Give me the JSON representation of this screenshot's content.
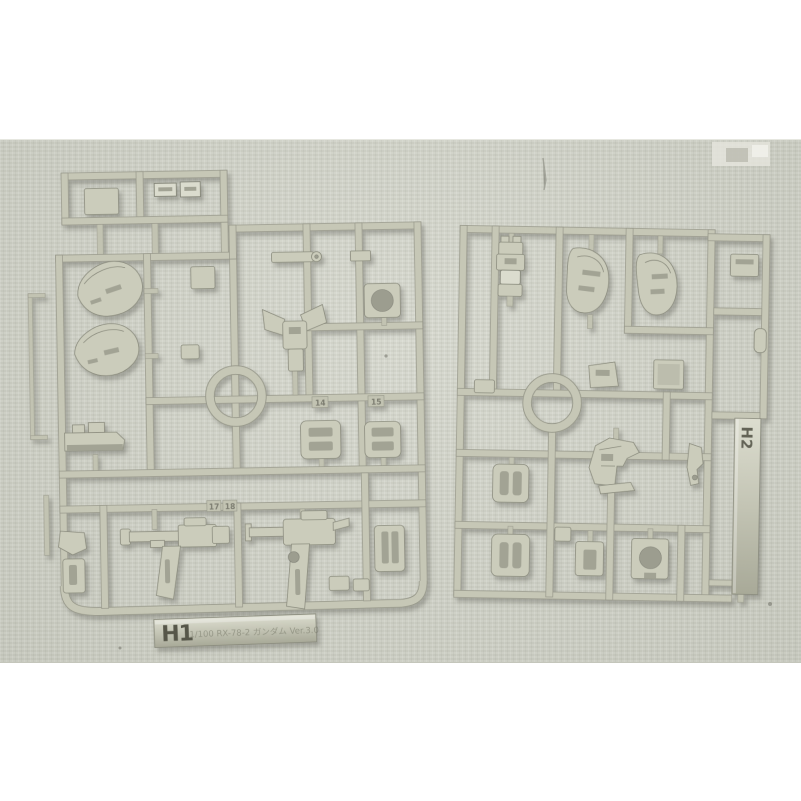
{
  "photo": {
    "subject": "Two beige plastic model-kit part runners (sprues) photographed on gray fabric",
    "fabric_hex": "#d2d4c9",
    "plastic_hex": "#c6c7b6",
    "border_hex": "#ffffff"
  },
  "left_runner": {
    "tag_label": "H1",
    "tag_inscription": "1/100 RX-78-2 ガンダム Ver.3.0",
    "molded_numbers": {
      "n14": "14",
      "n15": "15",
      "n17": "17",
      "n18": "18"
    }
  },
  "right_runner": {
    "tag_label": "H2"
  }
}
